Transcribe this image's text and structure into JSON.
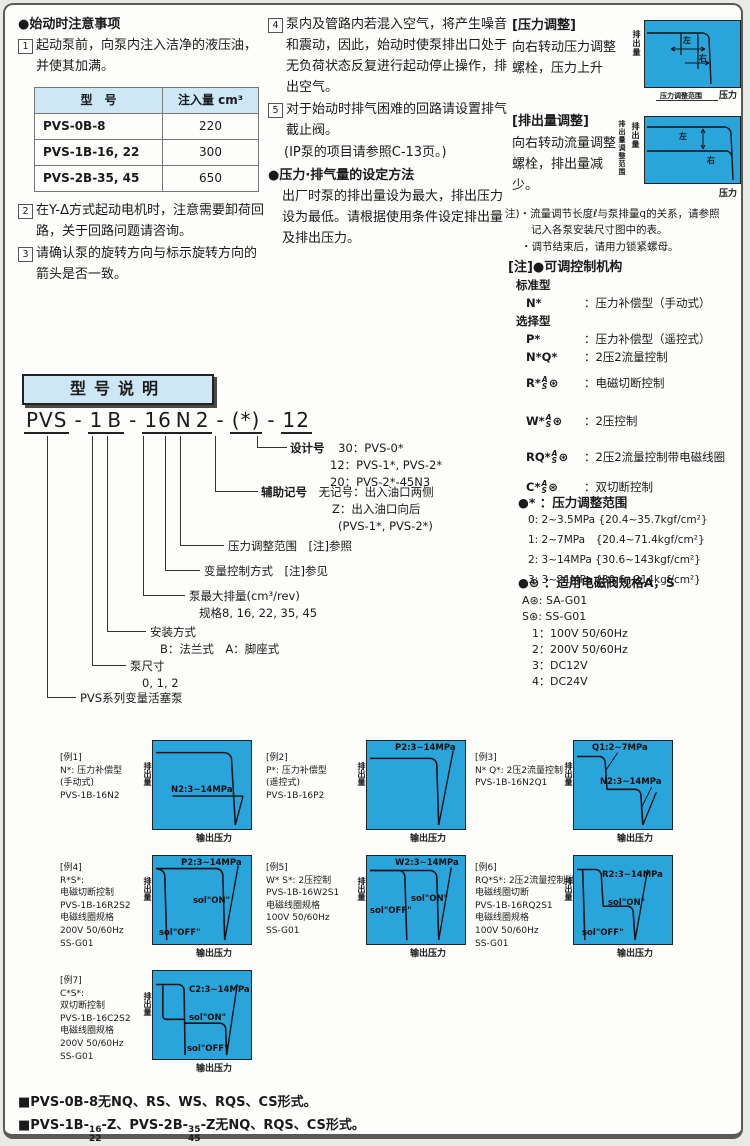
{
  "col1": {
    "title": "●始动时注意事项",
    "n1": "1",
    "item1": "起动泵前，向泵内注入洁净的液压油，并使其加满。",
    "table": {
      "h1": "型　号",
      "h2": "注入量 cm³",
      "rows": [
        [
          "PVS-0B-8",
          "220"
        ],
        [
          "PVS-1B-16, 22",
          "300"
        ],
        [
          "PVS-2B-35, 45",
          "650"
        ]
      ]
    },
    "n2": "2",
    "item2": "在Y-Δ方式起动电机时，注意需要卸荷回路，关于回路问题请咨询。",
    "n3": "3",
    "item3": "请确认泵的旋转方向与标示旋转方向的箭头是否一致。"
  },
  "col2": {
    "n4": "4",
    "item4": "泵内及管路内若混入空气，将产生噪音和震动，因此，始动时使泵排出口处于无负荷状态反复进行起动停止操作，排出空气。",
    "n5": "5",
    "item5": "对于始动时排气困难的回路请设置排气截止阀。",
    "item5_note": "(IP泵的项目请参照C-13页。)",
    "set_title": "●压力·排气量的设定方法",
    "set_body": "出厂时泵的排出量设为最大，排出压力设为最低。请根据使用条件设定排出量及排出压力。"
  },
  "col3": {
    "pa_title": "[压力调整]",
    "pa_body": "向右转动压力调整螺栓，压力上升",
    "pa_d": {
      "y": "排出量",
      "x": "压力",
      "left": "左",
      "right": "右",
      "range": "压力调整范围"
    },
    "fa_title": "[排出量调整]",
    "fa_body": "向右转动流量调整螺栓，排出量减少。",
    "fa_d": {
      "y": "排出量",
      "x": "压力",
      "left": "左",
      "right": "右",
      "range": "排出量调整范围"
    },
    "note1": "注)・流量调节长度ℓ与泵排量q的关系，请参照",
    "note2": "记入各泵安装尺寸图中的表。",
    "note3": "・调节结束后，请用力锁紧螺母。",
    "ctrl_title": "[注]●可调控制机构",
    "std": "标准型",
    "sel": "选择型",
    "ctrl": [
      {
        "code": "N*",
        "a": "",
        "s": "",
        "suf": "",
        "desc": "：压力补偿型（手动式）"
      },
      {
        "code": "P*",
        "a": "",
        "s": "",
        "suf": "",
        "desc": "：压力补偿型（遥控式）"
      },
      {
        "code": "N*Q*",
        "a": "",
        "s": "",
        "suf": "",
        "desc": "：2压2流量控制"
      },
      {
        "code": "R*",
        "a": "A",
        "s": "S",
        "suf": "⊛",
        "desc": "：电磁切断控制"
      },
      {
        "code": "W*",
        "a": "A",
        "s": "S",
        "suf": "⊛",
        "desc": "：2压控制"
      },
      {
        "code": "RQ*",
        "a": "A",
        "s": "S",
        "suf": "⊛",
        "desc": "：2压2流量控制带电磁线圈"
      },
      {
        "code": "C*",
        "a": "A",
        "s": "S",
        "suf": "⊛",
        "desc": "：双切断控制"
      }
    ],
    "range_title": "●* ：压力调整范围",
    "ranges": [
      "0: 2~3.5MPa {20.4~35.7kgf/cm²}",
      "1: 2~7MPa　{20.4~71.4kgf/cm²}",
      "2: 3~14MPa {30.6~143kgf/cm²}",
      "3: 3~21MPa {30.6~214kgf/cm²}"
    ],
    "sol_title": "●⊛ ：适用电磁阀规格A，S",
    "sol": [
      "A⊛: SA-G01",
      "S⊛: SS-G01",
      "1：100V 50/60Hz",
      "2：200V 50/60Hz",
      "3：DC12V",
      "4：DC24V"
    ]
  },
  "model": {
    "heading": "型号说明",
    "segs": [
      "PVS",
      "-",
      "1",
      "B",
      "-",
      "16",
      "N",
      "2",
      "-",
      "(*)",
      "-",
      "12"
    ],
    "callouts": [
      {
        "label": "设计号",
        "l1": "30：PVS-0*",
        "l2": "12：PVS-1*, PVS-2*",
        "l3": "20：PVS-2*-45N3"
      },
      {
        "label": "辅助记号",
        "l1": "无记号：出入油口两侧",
        "l2": "Z：出入油口向后",
        "l3": "(PVS-1*, PVS-2*)"
      },
      {
        "label": "压力调整范围　[注]参照"
      },
      {
        "label": "变量控制方式　[注]参见"
      },
      {
        "label": "泵最大排量(cm³/rev)",
        "l1": "规格8, 16, 22, 35, 45"
      },
      {
        "label": "安装方式",
        "l1": "B：法兰式　A：脚座式"
      },
      {
        "label": "泵尺寸",
        "l1": "0, 1, 2"
      },
      {
        "label": "PVS系列变量活塞泵"
      }
    ]
  },
  "examples": [
    {
      "tag": "[例1]",
      "l1": "N*: 压力补偿型",
      "l2": "(手动式)",
      "l3": "PVS-1B-16N2",
      "y": "排出量",
      "x": "输出压力",
      "mid": "N2:3~14MPa"
    },
    {
      "tag": "[例2]",
      "l1": "P*: 压力补偿型",
      "l2": "(遥控式)",
      "l3": "PVS-1B-16P2",
      "y": "排出量",
      "x": "输出压力",
      "top": "P2:3~14MPa"
    },
    {
      "tag": "[例3]",
      "l1": "N* Q*: 2压2流量控制",
      "l2": "PVS-1B-16N2Q1",
      "y": "排出量",
      "x": "输出压力",
      "top": "Q1:2~7MPa",
      "mid": "N2:3~14MPa"
    },
    {
      "tag": "[例4]",
      "l1": "R*S*:",
      "l2": "电磁切断控制",
      "l3": "PVS-1B-16R2S2",
      "l4": "电磁线圈规格",
      "l5": "200V 50/60Hz",
      "l6": "SS-G01",
      "y": "排出量",
      "x": "输出压力",
      "top": "P2:3~14MPa",
      "on": "sol\"ON\"",
      "off": "sol\"OFF\""
    },
    {
      "tag": "[例5]",
      "l1": "W* S*: 2压控制",
      "l2": "PVS-1B-16W2S1",
      "l3": "电磁线圈规格",
      "l4": "100V 50/60Hz",
      "l5": "SS-G01",
      "y": "排出量",
      "x": "输出压力",
      "top": "W2:3~14MPa",
      "on": "sol\"ON\"",
      "off": "sol\"OFF\""
    },
    {
      "tag": "[例6]",
      "l1": "RQ*S*: 2压2流量控制附",
      "l2": "电磁线圈切断",
      "l3": "PVS-1B-16RQ2S1",
      "l4": "电磁线圈规格",
      "l5": "100V 50/60Hz",
      "l6": "SS-G01",
      "y": "排出量",
      "x": "输出压力",
      "top": "R2:3~14MPa",
      "on": "sol\"ON\"",
      "off": "sol\"OFF\""
    },
    {
      "tag": "[例7]",
      "l1": "C*S*:",
      "l2": "双切断控制",
      "l3": "PVS-1B-16C2S2",
      "l4": "电磁线圈规格",
      "l5": "200V 50/60Hz",
      "l6": "SS-G01",
      "y": "排出量",
      "x": "输出压力",
      "top": "C2:3~14MPa",
      "on": "sol\"ON\"",
      "off": "sol\"OFF\""
    }
  ],
  "footer": {
    "line1": "■PVS-0B-8无NQ、RS、WS、RQS、CS形式。",
    "l2p1": "■PVS-1B-",
    "f1t": "16",
    "f1b": "22",
    "l2p2": "-Z、PVS-2B-",
    "f2t": "35",
    "f2b": "45",
    "l2p3": "-Z无NQ、RQS、CS形式。"
  }
}
